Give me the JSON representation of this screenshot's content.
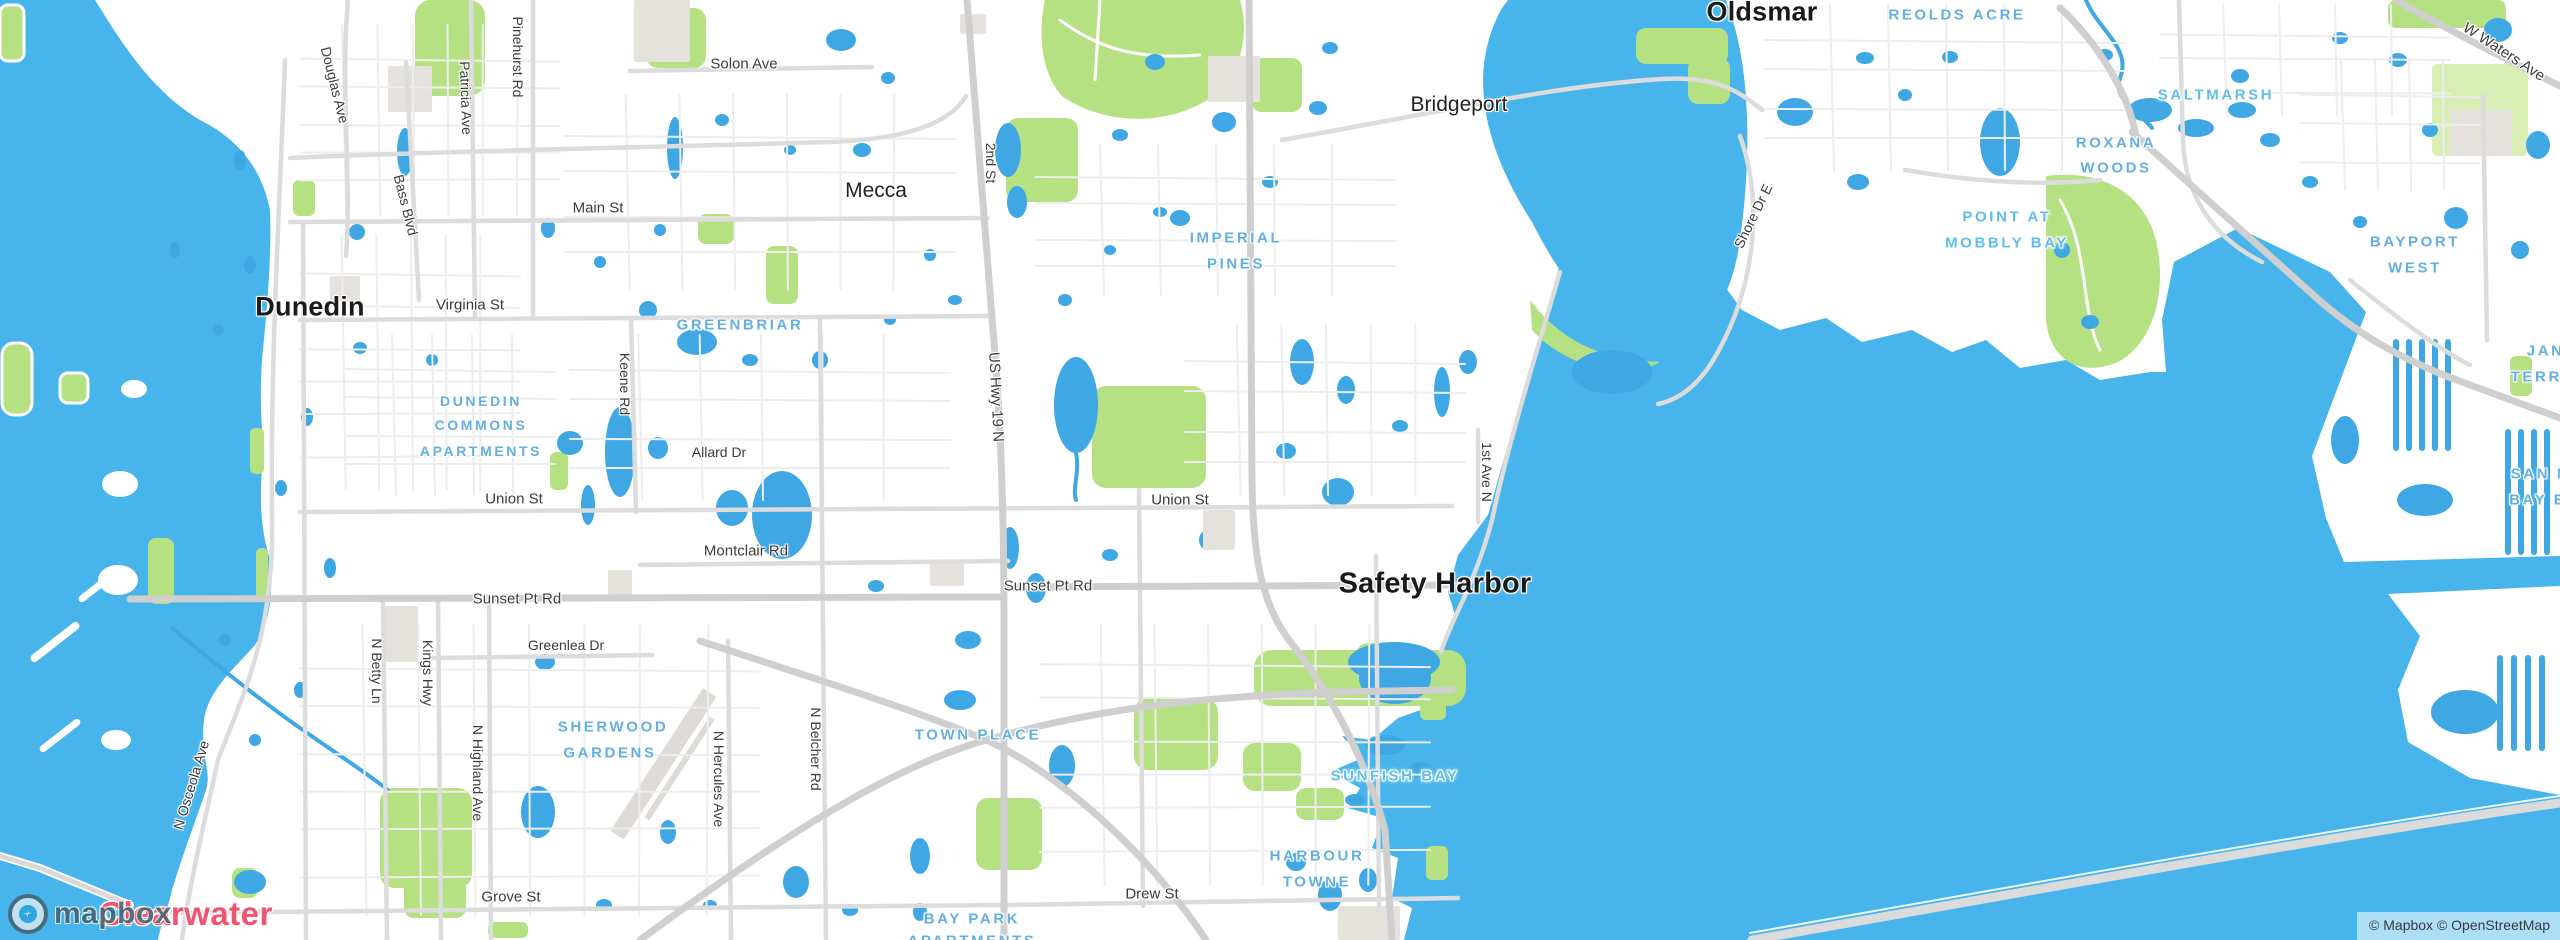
{
  "map": {
    "attribution": {
      "text": "© Mapbox © OpenStreetMap"
    },
    "logo": {
      "icon": "mapbox-compass-icon",
      "wordmark": "mapbox"
    },
    "colors": {
      "sea": "#47b5eb",
      "pond": "#3fa8e4",
      "park": "#b6e182",
      "park_light": "#d8eeb5",
      "road_minor": "#ededed",
      "road_major": "#dcdcdc",
      "road_highway": "#cfcfcf",
      "building": "#e5e2de",
      "label_hood": "#62b0e2",
      "label_water": "#5fbeee",
      "label_city": "#1a1a1a",
      "label_highlight": "#f2536f"
    },
    "labels": [
      {
        "id": "dunedin",
        "text": "Dunedin",
        "type": "city",
        "x": 310,
        "y": 307,
        "size": 27
      },
      {
        "id": "oldsmar",
        "text": "Oldsmar",
        "type": "city",
        "x": 1762,
        "y": 12,
        "size": 27
      },
      {
        "id": "safety-harbor",
        "text": "Safety Harbor",
        "type": "city",
        "x": 1435,
        "y": 584,
        "size": 29
      },
      {
        "id": "clearwater",
        "text": "Clearwater",
        "type": "city-pink",
        "x": 186,
        "y": 914,
        "size": 33
      },
      {
        "id": "bridgeport",
        "text": "Bridgeport",
        "type": "town",
        "x": 1459,
        "y": 105,
        "size": 21
      },
      {
        "id": "mecca",
        "text": "Mecca",
        "type": "town",
        "x": 876,
        "y": 191,
        "size": 21
      },
      {
        "id": "solon-ave",
        "text": "Solon Ave",
        "type": "road",
        "x": 744,
        "y": 64,
        "size": 15
      },
      {
        "id": "main-st",
        "text": "Main St",
        "type": "road",
        "x": 598,
        "y": 208,
        "size": 15
      },
      {
        "id": "virginia-st",
        "text": "Virginia St",
        "type": "road",
        "x": 470,
        "y": 305,
        "size": 15
      },
      {
        "id": "union-st-w",
        "text": "Union St",
        "type": "road",
        "x": 514,
        "y": 499,
        "size": 15
      },
      {
        "id": "union-st-e",
        "text": "Union St",
        "type": "road",
        "x": 1180,
        "y": 500,
        "size": 15
      },
      {
        "id": "allard-dr",
        "text": "Allard Dr",
        "type": "road",
        "x": 719,
        "y": 452,
        "size": 14
      },
      {
        "id": "montclair-rd",
        "text": "Montclair Rd",
        "type": "road",
        "x": 746,
        "y": 551,
        "size": 15
      },
      {
        "id": "sunset-pt-rd-w",
        "text": "Sunset Pt Rd",
        "type": "road",
        "x": 517,
        "y": 599,
        "size": 15
      },
      {
        "id": "sunset-pt-rd-e",
        "text": "Sunset Pt Rd",
        "type": "road",
        "x": 1048,
        "y": 586,
        "size": 15
      },
      {
        "id": "greenlea-dr",
        "text": "Greenlea Dr",
        "type": "road",
        "x": 566,
        "y": 645,
        "size": 14
      },
      {
        "id": "grove-st",
        "text": "Grove St",
        "type": "road",
        "x": 511,
        "y": 897,
        "size": 15
      },
      {
        "id": "drew-st",
        "text": "Drew St",
        "type": "road",
        "x": 1152,
        "y": 894,
        "size": 15
      },
      {
        "id": "douglas-ave",
        "text": "Douglas Ave",
        "type": "road",
        "x": 335,
        "y": 85,
        "size": 14,
        "rot": 76
      },
      {
        "id": "bass-blvd",
        "text": "Bass Blvd",
        "type": "road",
        "x": 406,
        "y": 205,
        "size": 14,
        "rot": 76
      },
      {
        "id": "patricia-ave",
        "text": "Patricia Ave",
        "type": "road",
        "x": 466,
        "y": 98,
        "size": 14,
        "rot": 88
      },
      {
        "id": "pinehurst-rd",
        "text": "Pinehurst Rd",
        "type": "road",
        "x": 518,
        "y": 57,
        "size": 14,
        "rot": 90
      },
      {
        "id": "keene-rd",
        "text": "Keene Rd",
        "type": "road",
        "x": 625,
        "y": 384,
        "size": 14,
        "rot": 90
      },
      {
        "id": "second-st",
        "text": "2nd St",
        "type": "road",
        "x": 991,
        "y": 163,
        "size": 14,
        "rot": 90
      },
      {
        "id": "us-hwy-19-n",
        "text": "US Hwy 19 N",
        "type": "road",
        "x": 996,
        "y": 397,
        "size": 15,
        "rot": 87
      },
      {
        "id": "first-ave-n",
        "text": "1st Ave N",
        "type": "road",
        "x": 1487,
        "y": 472,
        "size": 14,
        "rot": 90
      },
      {
        "id": "n-betty-ln",
        "text": "N Betty Ln",
        "type": "road",
        "x": 377,
        "y": 671,
        "size": 14,
        "rot": 90
      },
      {
        "id": "kings-hwy",
        "text": "Kings Hwy",
        "type": "road",
        "x": 428,
        "y": 673,
        "size": 14,
        "rot": 90
      },
      {
        "id": "n-highland-ave",
        "text": "N Highland Ave",
        "type": "road",
        "x": 478,
        "y": 773,
        "size": 14,
        "rot": 90
      },
      {
        "id": "n-hercules-ave",
        "text": "N Hercules Ave",
        "type": "road",
        "x": 719,
        "y": 779,
        "size": 14,
        "rot": 90
      },
      {
        "id": "n-belcher-rd",
        "text": "N Belcher Rd",
        "type": "road",
        "x": 816,
        "y": 749,
        "size": 14,
        "rot": 90
      },
      {
        "id": "n-osceola-ave",
        "text": "N Osceola Ave",
        "type": "road",
        "x": 191,
        "y": 785,
        "size": 14,
        "rot": -73
      },
      {
        "id": "shore-dr-e",
        "text": "Shore Dr E",
        "type": "road",
        "x": 1753,
        "y": 216,
        "size": 14,
        "rot": -64
      },
      {
        "id": "w-waters-ave",
        "text": "W Waters Ave",
        "type": "road",
        "x": 2504,
        "y": 52,
        "size": 15,
        "rot": 33
      },
      {
        "id": "reolds-acre",
        "text": "REOLDS ACRE",
        "type": "hood",
        "x": 1957,
        "y": 15,
        "size": 15
      },
      {
        "id": "saltmarsh",
        "text": "SALTMARSH",
        "type": "water",
        "x": 2216,
        "y": 95,
        "size": 15
      },
      {
        "id": "roxana-woods-1",
        "text": "ROXANA",
        "type": "hood",
        "x": 2116,
        "y": 143,
        "size": 15
      },
      {
        "id": "roxana-woods-2",
        "text": "WOODS",
        "type": "hood",
        "x": 2116,
        "y": 168,
        "size": 15
      },
      {
        "id": "point-at-mobbly-bay-1",
        "text": "POINT AT",
        "type": "water",
        "x": 2007,
        "y": 217,
        "size": 15
      },
      {
        "id": "point-at-mobbly-bay-2",
        "text": "MOBBLY BAY",
        "type": "water",
        "x": 2007,
        "y": 243,
        "size": 15
      },
      {
        "id": "bayport-west-1",
        "text": "BAYPORT",
        "type": "hood",
        "x": 2415,
        "y": 242,
        "size": 15
      },
      {
        "id": "bayport-west-2",
        "text": "WEST",
        "type": "hood",
        "x": 2415,
        "y": 268,
        "size": 15
      },
      {
        "id": "jane-terrace-1",
        "text": "JANE",
        "type": "hood",
        "x": 2552,
        "y": 351,
        "size": 15
      },
      {
        "id": "jane-terrace-2",
        "text": "TERRACE",
        "type": "hood",
        "x": 2556,
        "y": 377,
        "size": 15
      },
      {
        "id": "san-marino-1",
        "text": "SAN MARINO",
        "type": "hood",
        "x": 2572,
        "y": 474,
        "size": 15
      },
      {
        "id": "san-marino-2",
        "text": "BAY ESTATES",
        "type": "hood",
        "x": 2574,
        "y": 500,
        "size": 15
      },
      {
        "id": "imperial-pines-1",
        "text": "IMPERIAL",
        "type": "hood",
        "x": 1236,
        "y": 238,
        "size": 15
      },
      {
        "id": "imperial-pines-2",
        "text": "PINES",
        "type": "hood",
        "x": 1236,
        "y": 264,
        "size": 15
      },
      {
        "id": "greenbriar",
        "text": "GREENBRIAR",
        "type": "hood",
        "x": 740,
        "y": 325,
        "size": 15
      },
      {
        "id": "dunedin-commons-1",
        "text": "DUNEDIN",
        "type": "hood",
        "x": 481,
        "y": 401,
        "size": 14
      },
      {
        "id": "dunedin-commons-2",
        "text": "COMMONS",
        "type": "hood",
        "x": 481,
        "y": 425,
        "size": 14
      },
      {
        "id": "dunedin-commons-3",
        "text": "APARTMENTS",
        "type": "hood",
        "x": 481,
        "y": 451,
        "size": 14
      },
      {
        "id": "sherwood-gardens-1",
        "text": "SHERWOOD",
        "type": "hood",
        "x": 613,
        "y": 727,
        "size": 15
      },
      {
        "id": "sherwood-gardens-2",
        "text": "GARDENS",
        "type": "hood",
        "x": 610,
        "y": 753,
        "size": 15
      },
      {
        "id": "town-place",
        "text": "TOWN PLACE",
        "type": "hood",
        "x": 978,
        "y": 735,
        "size": 15
      },
      {
        "id": "sunfish-bay",
        "text": "SUNFISH BAY",
        "type": "water",
        "x": 1395,
        "y": 776,
        "size": 15
      },
      {
        "id": "harbour-towne-1",
        "text": "HARBOUR",
        "type": "hood",
        "x": 1317,
        "y": 856,
        "size": 15
      },
      {
        "id": "harbour-towne-2",
        "text": "TOWNE",
        "type": "hood",
        "x": 1317,
        "y": 882,
        "size": 15
      },
      {
        "id": "bay-park-1",
        "text": "BAY PARK",
        "type": "hood",
        "x": 972,
        "y": 919,
        "size": 15
      },
      {
        "id": "bay-park-2",
        "text": "APARTMENTS",
        "type": "hood",
        "x": 972,
        "y": 941,
        "size": 15
      }
    ]
  }
}
